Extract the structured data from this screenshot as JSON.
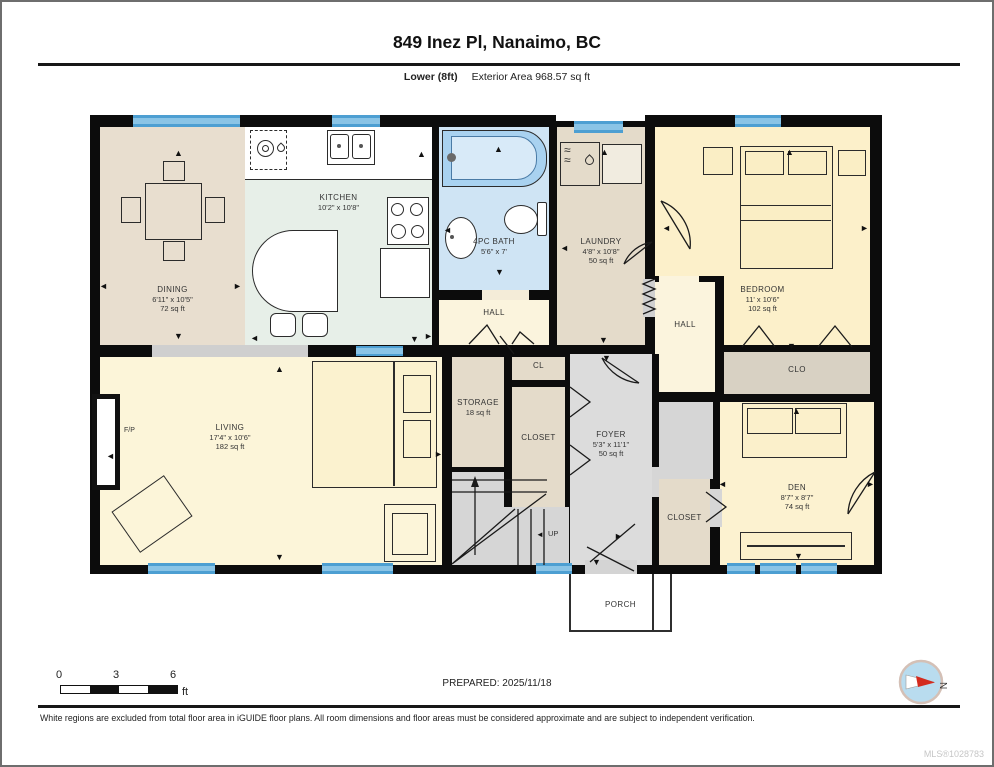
{
  "header": {
    "title": "849 Inez Pl, Nanaimo, BC",
    "floor_label": "Lower (8ft)",
    "area_label": "Exterior Area 968.57 sq ft"
  },
  "rooms": {
    "dining": {
      "name": "DINING",
      "dims": "6'11\" x 10'5\"",
      "area": "72 sq ft"
    },
    "kitchen": {
      "name": "KITCHEN",
      "dims": "10'2\" x 10'8\""
    },
    "bath": {
      "name": "4PC BATH",
      "dims": "5'6\" x 7'"
    },
    "laundry": {
      "name": "LAUNDRY",
      "dims": "4'8\" x 10'8\"",
      "area": "50 sq ft"
    },
    "bedroom": {
      "name": "BEDROOM",
      "dims": "11' x 10'6\"",
      "area": "102 sq ft"
    },
    "hall_left": {
      "name": "HALL"
    },
    "hall_right": {
      "name": "HALL"
    },
    "clo": {
      "name": "CLO"
    },
    "living": {
      "name": "LIVING",
      "dims": "17'4\" x 10'6\"",
      "area": "182 sq ft"
    },
    "storage": {
      "name": "STORAGE",
      "area": "18 sq ft"
    },
    "cl": {
      "name": "CL"
    },
    "closet_center": {
      "name": "CLOSET"
    },
    "foyer": {
      "name": "FOYER",
      "dims": "5'3\" x 11'1\"",
      "area": "50 sq ft"
    },
    "closet_right": {
      "name": "CLOSET"
    },
    "den": {
      "name": "DEN",
      "dims": "8'7\" x 8'7\"",
      "area": "74 sq ft"
    },
    "porch": {
      "name": "PORCH"
    }
  },
  "plan_labels": {
    "fireplace": "F/P",
    "stairs_up": "UP",
    "north": "N"
  },
  "scale_bar": {
    "ticks": [
      "0",
      "3",
      "6"
    ],
    "unit": "ft"
  },
  "footer": {
    "prepared": "PREPARED: 2025/11/18",
    "disclaimer": "White regions are excluded from total floor area in iGUIDE floor plans. All room dimensions and floor areas must be considered approximate and are subject to independent verification.",
    "mls": "MLS®1028783"
  },
  "colors": {
    "wall": "#0c0c0c",
    "window_blue": "#4d9fd2",
    "bath_blue": "#cfe4f4",
    "tan": "#e4dbca",
    "dining_tan": "#e8decf",
    "mint": "#e7efe8",
    "cream": "#fbf4dd",
    "yellow": "#fcf0ca",
    "floor_gray": "#dcdcdc",
    "clo_gray": "#d8d1c3"
  }
}
